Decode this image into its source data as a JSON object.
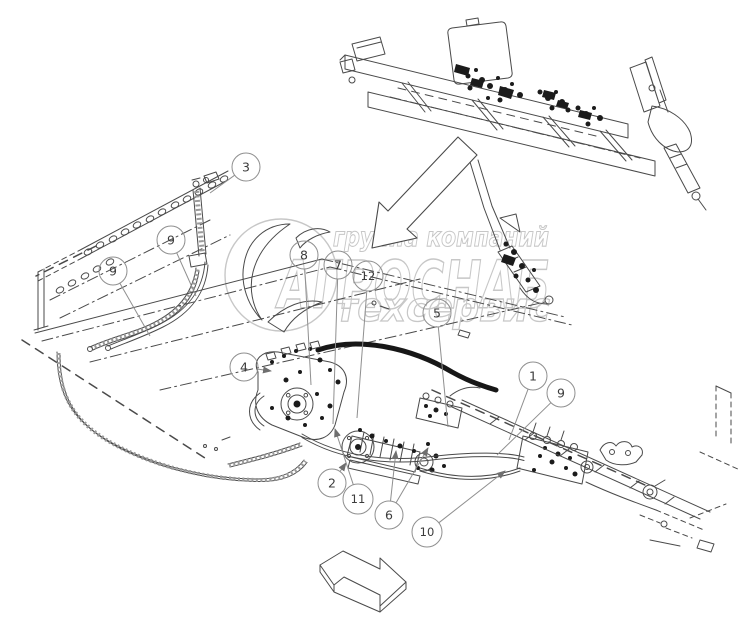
{
  "diagram": {
    "kind": "exploded-parts-line-drawing",
    "background_color": "#ffffff",
    "line_color": "#4a4a4a",
    "dark_fill_color": "#1b1b1b",
    "hose_color": "#171717",
    "callout_color": "#8f8f8f",
    "watermark_color": "#c7c7c7"
  },
  "watermark": {
    "line1": "группа компаний",
    "line2": "АГРОСНАБ",
    "line3": "техсервис"
  },
  "icons": {
    "transfer_arrow": "arrow-down-left",
    "direction_arrow": "arrow-down-right",
    "logo": "circle-leaf-logo"
  },
  "callouts": [
    {
      "label": "3",
      "x": 246,
      "y": 167,
      "leaders": [
        [
          210,
          193
        ]
      ],
      "arrow": false
    },
    {
      "label": "9",
      "x": 171,
      "y": 240,
      "leaders": [
        [
          196,
          296
        ]
      ],
      "arrow": false
    },
    {
      "label": "9",
      "x": 113,
      "y": 271,
      "leaders": [
        [
          150,
          336
        ]
      ],
      "arrow": false
    },
    {
      "label": "8",
      "x": 304,
      "y": 255,
      "leaders": [
        [
          311,
          385
        ]
      ],
      "arrow": false
    },
    {
      "label": "7",
      "x": 338,
      "y": 265,
      "leaders": [
        [
          333,
          424
        ]
      ],
      "arrow": false
    },
    {
      "label": "12",
      "x": 368,
      "y": 276,
      "leaders": [
        [
          357,
          418
        ]
      ],
      "arrow": false
    },
    {
      "label": "5",
      "x": 437,
      "y": 313,
      "leaders": [
        [
          448,
          427
        ]
      ],
      "arrow": false
    },
    {
      "label": "4",
      "x": 244,
      "y": 367,
      "leaders": [
        [
          271,
          371
        ]
      ],
      "arrow": true
    },
    {
      "label": "1",
      "x": 533,
      "y": 376,
      "leaders": [
        [
          509,
          440
        ]
      ],
      "arrow": false
    },
    {
      "label": "9",
      "x": 561,
      "y": 393,
      "leaders": [
        [
          497,
          455
        ]
      ],
      "arrow": false
    },
    {
      "label": "2",
      "x": 332,
      "y": 483,
      "leaders": [
        [
          346,
          463
        ]
      ],
      "arrow": true
    },
    {
      "label": "11",
      "x": 358,
      "y": 499,
      "leaders": [
        [
          335,
          429
        ]
      ],
      "arrow": true
    },
    {
      "label": "6",
      "x": 389,
      "y": 515,
      "leaders": [
        [
          396,
          451
        ],
        [
          428,
          448
        ]
      ],
      "arrow": true
    },
    {
      "label": "10",
      "x": 427,
      "y": 532,
      "leaders": [
        [
          505,
          471
        ]
      ],
      "arrow": true
    }
  ]
}
